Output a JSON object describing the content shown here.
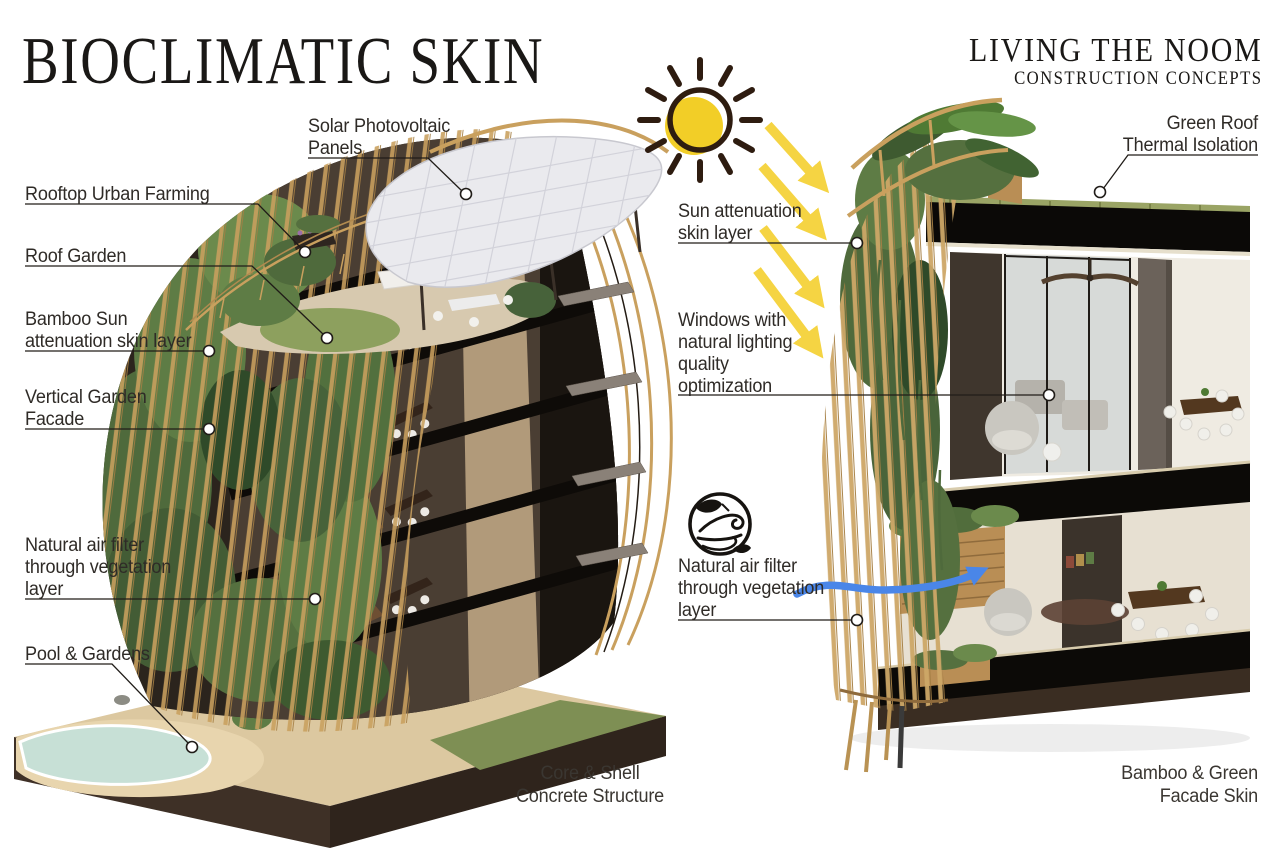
{
  "header": {
    "title": "BIOCLIMATIC SKIN",
    "brand": "LIVING THE NOOM",
    "brand_subtitle": "CONSTRUCTION CONCEPTS"
  },
  "left_building": {
    "caption": "Core & Shell\nConcrete Structure",
    "callouts": {
      "solar_pv": "Solar Photovoltaic\nPanels",
      "rooftop_urban_farming": "Rooftop Urban Farming",
      "roof_garden": "Roof Garden",
      "bamboo_sun_skin": "Bamboo Sun\nattenuation skin layer",
      "vertical_garden_facade": "Vertical Garden\nFacade",
      "natural_air_filter": "Natural air filter\nthrough vegetation\nlayer",
      "pool_gardens": "Pool & Gardens"
    }
  },
  "right_building": {
    "caption": "Bamboo & Green\nFacade Skin",
    "callouts": {
      "green_roof": "Green Roof\nThermal Isolation",
      "sun_attenuation_skin": "Sun attenuation\nskin layer",
      "windows_daylight": "Windows with\nnatural lighting\nquality\noptimization",
      "natural_air_filter": "Natural air filter\nthrough vegetation\nlayer"
    }
  },
  "icons": {
    "sun": "sun-icon",
    "sun_rays": "sun-ray-arrows-icon",
    "air_flow": "wind-leaf-icon",
    "air_arrow": "blue-airflow-arrow-icon"
  },
  "colors": {
    "sun_yellow": "#F2CE27",
    "arrow_yellow": "#F5D443",
    "airflow_blue": "#4A86E8",
    "bamboo_tan": "#C9A05E",
    "foliage_green": "#5D7A44",
    "structure_dark": "#14100C",
    "text_dark": "#2F2B27",
    "background": "#FFFFFF"
  }
}
